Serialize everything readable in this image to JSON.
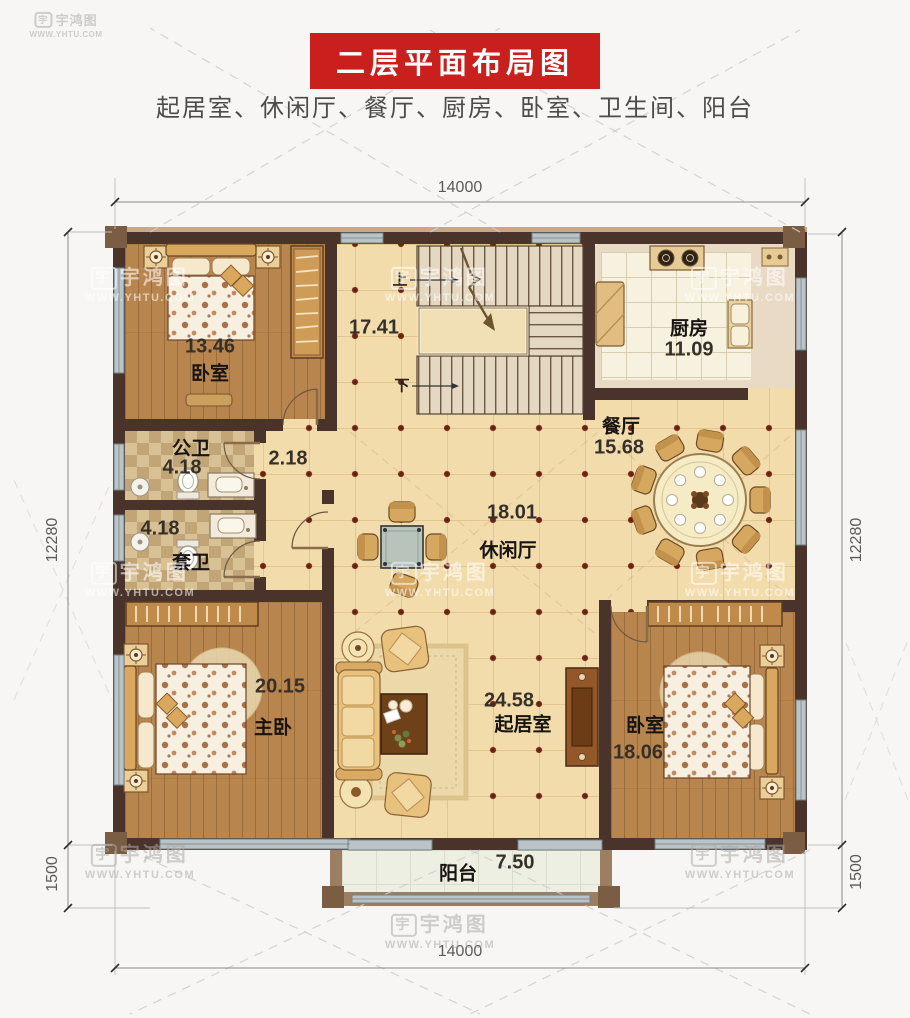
{
  "header": {
    "title": "二层平面布局图",
    "subtitle": "起居室、休闲厅、餐厅、厨房、卧室、卫生间、阳台"
  },
  "watermark": {
    "icon": "宇",
    "brand": "宇鸿图",
    "url": "WWW.YHTU.COM"
  },
  "dims": {
    "top": "14000",
    "bottom": "14000",
    "left": "12280",
    "left_lower": "1500",
    "right": "12280",
    "right_lower": "1500"
  },
  "rooms": {
    "bedroom1": {
      "area": "13.46",
      "label": "卧室"
    },
    "stairhall": {
      "area": "17.41",
      "up": "上",
      "down": "下"
    },
    "kitchen": {
      "label": "厨房",
      "area": "11.09"
    },
    "dining": {
      "label": "餐厅",
      "area": "15.68"
    },
    "bath_public": {
      "label": "公卫",
      "area": "4.18"
    },
    "bath_ensuite": {
      "label": "套卫",
      "area": "4.18"
    },
    "hallway": {
      "area": "2.18"
    },
    "lounge": {
      "area": "18.01",
      "label": "休闲厅"
    },
    "master": {
      "area": "20.15",
      "label": "主卧"
    },
    "living": {
      "area": "24.58",
      "label": "起居室"
    },
    "bedroom2": {
      "label": "卧室",
      "area": "18.06"
    },
    "balcony": {
      "label": "阳台",
      "area": "7.50"
    }
  },
  "colors": {
    "title_bg": "#c9201d",
    "wall": "#49332a",
    "tile": "#f3dcab",
    "wood": "#b9854e",
    "tile_dot": "#6e2214",
    "window": "#bac3c7"
  }
}
